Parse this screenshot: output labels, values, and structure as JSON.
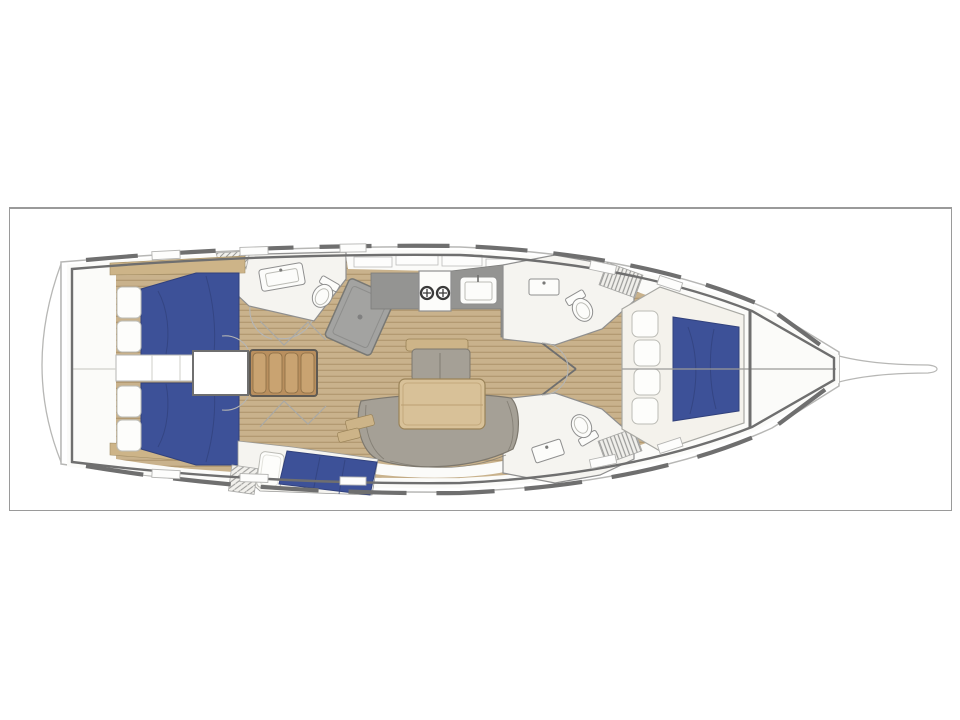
{
  "figure": {
    "type": "sailing-yacht-interior-floor-plan",
    "orientation": "bow-right"
  },
  "regions": [
    "transom-platform",
    "port-aft-cabin",
    "starboard-aft-cabin",
    "aft-corridor",
    "engine-box",
    "companionway-steps",
    "aft-head-with-shower",
    "galley",
    "salon-dining-area",
    "aft-bunk-berth",
    "forward-head-port",
    "forward-head-starboard",
    "forward-owner-cabin",
    "anchor-locker",
    "bowsprit"
  ],
  "colors": {
    "page_bg": "#ffffff",
    "frame_border": "#9a9a9a",
    "hull_line": "#b7b7b5",
    "wall": "#6f6f6f",
    "deck_white": "#ffffff",
    "interior_white": "#fbfbf9",
    "room_white": "#f5f4f0",
    "room_line": "#8f8f8f",
    "teak": "#c9b28c",
    "teak_seam": "#b39a72",
    "wood_trim": "#cdb488",
    "wood_table": "#d8c198",
    "wood_edge": "#9a8358",
    "wood_steps": "#c9a371",
    "steps_frame": "#5f5a52",
    "bed_blue": "#3d5198",
    "bed_fold": "#31417c",
    "cushion": "#fdfdfb",
    "cushion_line": "#bcbcb6",
    "upholstery": "#a5a096",
    "upholstery_line": "#7d786e",
    "counter": "#949492",
    "shower": "#a3a3a1",
    "fixture": "#fcfcfa",
    "fixture_line": "#8f8f8f",
    "hatch_line": "#9a9a98",
    "arc_line": "#b5b5b3"
  }
}
